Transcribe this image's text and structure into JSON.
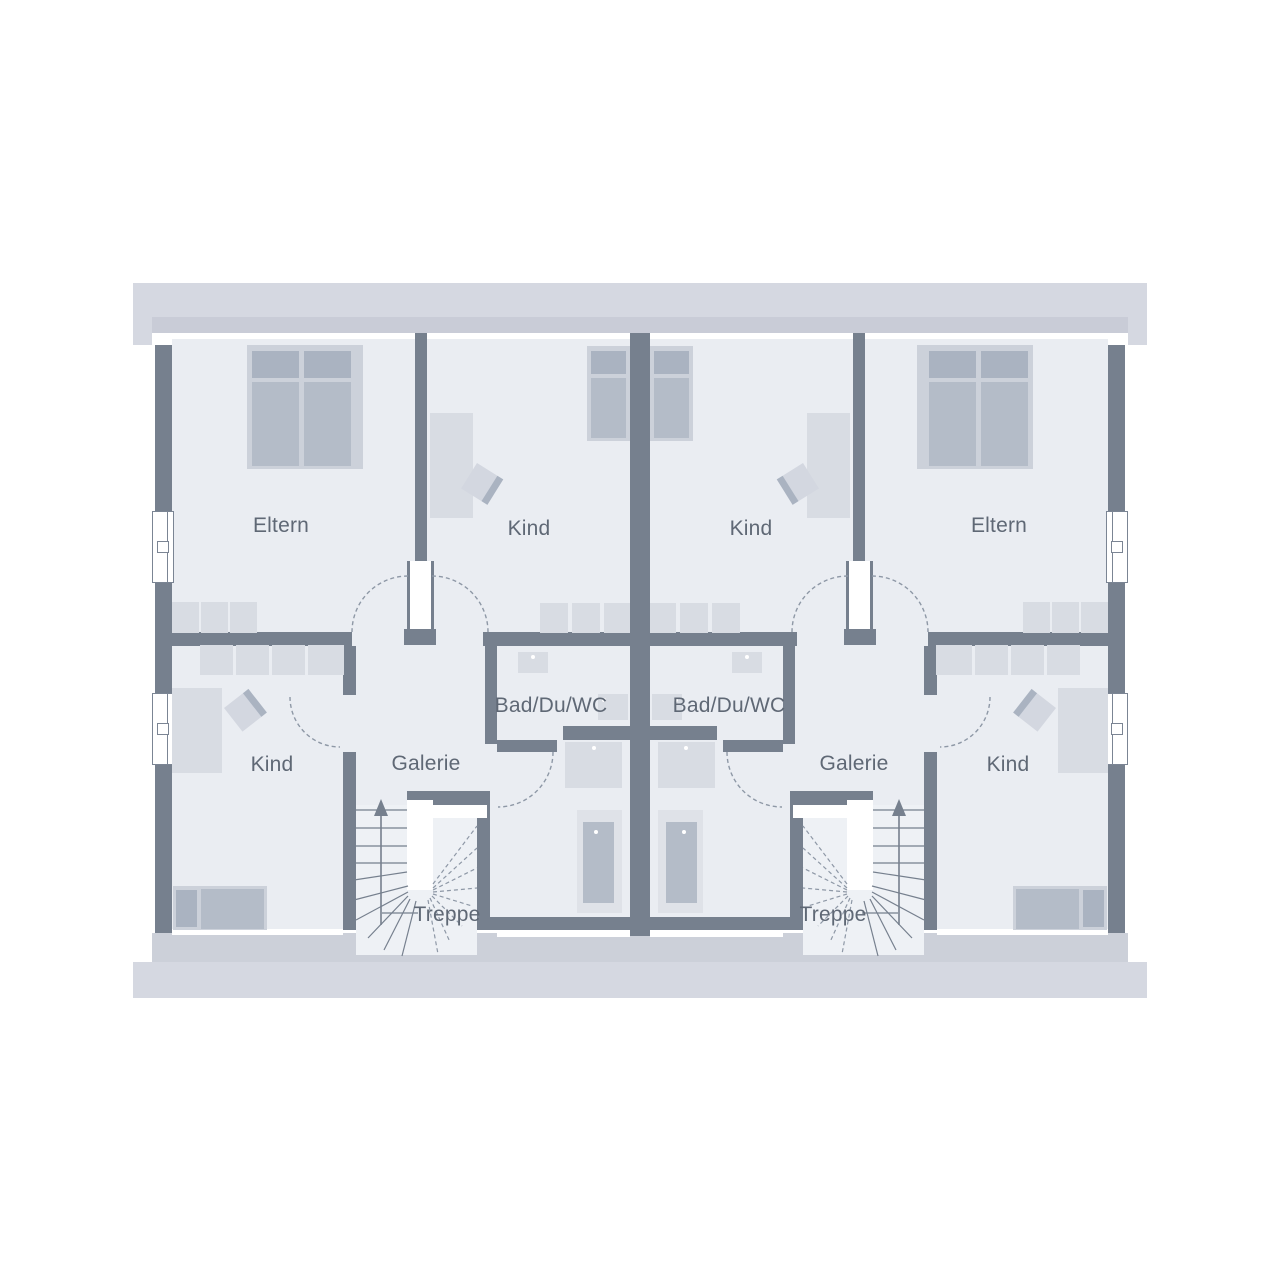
{
  "plan": {
    "type": "floor-plan",
    "rooms": {
      "eltern": "Eltern",
      "kind": "Kind",
      "bad": "Bad/Du/WC",
      "galerie": "Galerie",
      "treppe": "Treppe"
    },
    "colors": {
      "wall": "#76808e",
      "floor": "#eaedf2",
      "roof_light": "#d5d8e1",
      "roof_shadow": "#c9ccd7",
      "ground_light": "#d5d8e1",
      "ground_shadow": "#ccd0d9",
      "furniture_light": "#d8dce3",
      "furniture_dark": "#aab3c1",
      "bed_frame": "#ccd1da",
      "mattress": "#b4bcc8",
      "label_text": "#5f6875",
      "dashed_line": "#8e98a6"
    }
  }
}
